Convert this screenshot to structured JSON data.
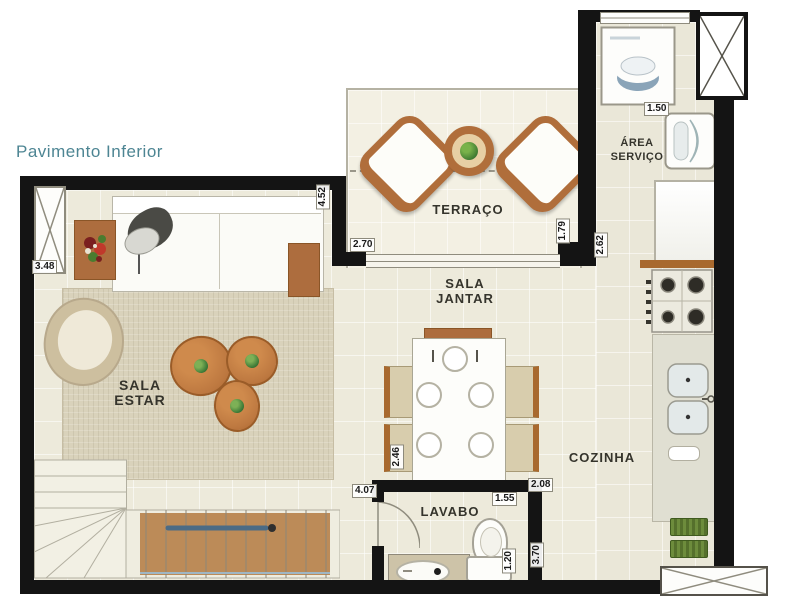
{
  "title": "Pavimento Inferior",
  "colors": {
    "title_accent": "#4d8593",
    "wall": "#141414",
    "floor": "#edeadb",
    "wood": "#b06e3b",
    "rail_blue": "#4b6b85"
  },
  "rooms": {
    "terraco": {
      "label": "TERRAÇO"
    },
    "sala_jantar": {
      "line1": "SALA",
      "line2": "JANTAR"
    },
    "sala_estar": {
      "line1": "SALA",
      "line2": "ESTAR"
    },
    "area_servico": {
      "line1": "ÁREA",
      "line2": "SERVIÇO"
    },
    "cozinha": {
      "label": "COZINHA"
    },
    "lavabo": {
      "label": "LAVABO"
    }
  },
  "dimensions": {
    "living_window": "3.48",
    "living_depth": "4.52",
    "terraco_width": "2.70",
    "terraco_depth": "1.79",
    "servico_wall": "2.62",
    "servico_width": "1.50",
    "jantar_width": "2.46",
    "cozinha_pass": "2.08",
    "hall_length": "4.07",
    "lavabo_width": "1.55",
    "lavabo_depth": "1.20",
    "cozinha_depth": "3.70"
  }
}
